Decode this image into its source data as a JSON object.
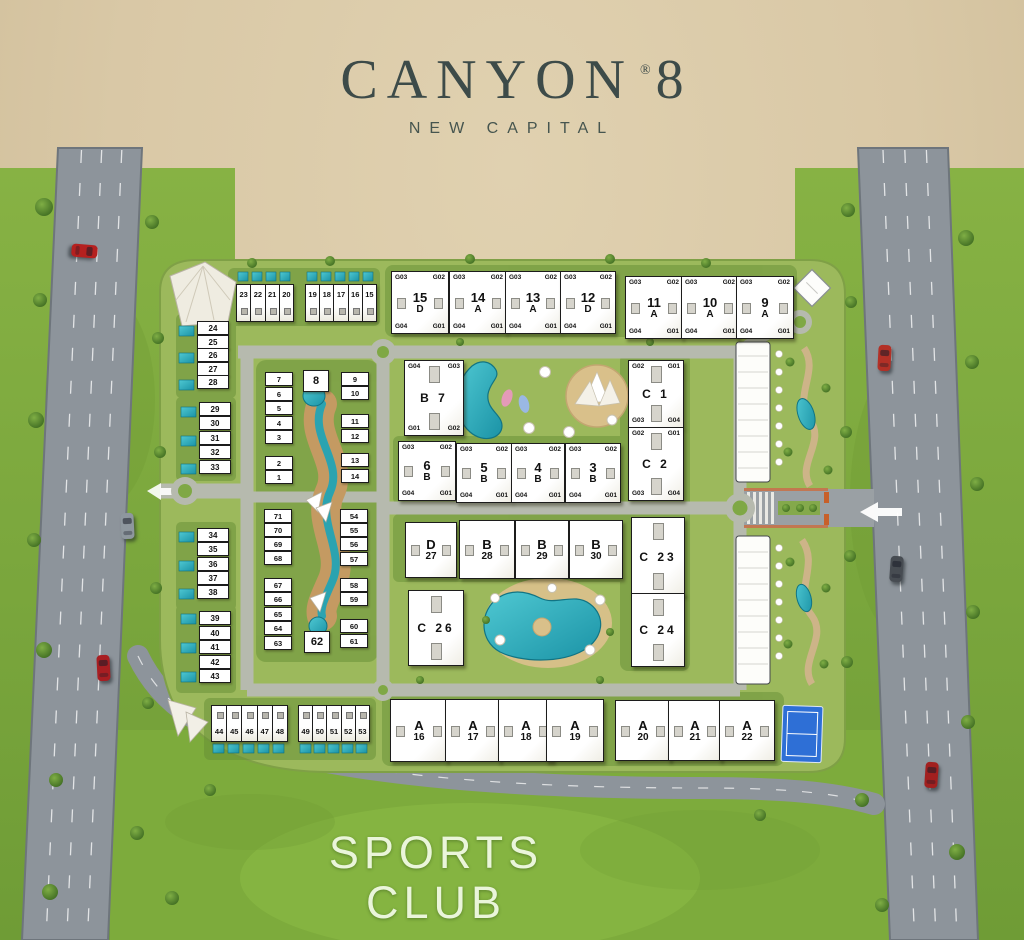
{
  "title": {
    "brand": "CANYON",
    "reg": "®",
    "number": "8",
    "subtitle": "NEW CAPITAL"
  },
  "sports_club": {
    "line1": "SPORTS",
    "line2": "CLUB"
  },
  "colors": {
    "background": "#d9c8a6",
    "grass": "#7fa93f",
    "site": "#9cb95c",
    "road": "#8d949b",
    "inner_road": "#b6baae",
    "pool": "#2aa8b5",
    "sand": "#d9c08a",
    "canyon_path": "#c49a62",
    "building": "#ffffff",
    "building_border": "#1c1c1c",
    "title_text": "#3d4b49",
    "sports_text": "#eaf5da",
    "court": "#2e6fd6"
  },
  "buildings": [
    {
      "id": "15-D",
      "x": 391,
      "y": 271,
      "w": 56,
      "h": 61,
      "top": "15",
      "bottom": "D",
      "corners": {
        "tl": "G03",
        "tr": "G02",
        "bl": "G04",
        "br": "G01"
      },
      "win": "h"
    },
    {
      "id": "14-A",
      "x": 449,
      "y": 271,
      "w": 56,
      "h": 61,
      "top": "14",
      "bottom": "A",
      "corners": {
        "tl": "G03",
        "tr": "G02",
        "bl": "G04",
        "br": "G01"
      },
      "win": "h"
    },
    {
      "id": "13-A",
      "x": 505,
      "y": 271,
      "w": 54,
      "h": 61,
      "top": "13",
      "bottom": "A",
      "corners": {
        "tl": "G03",
        "tr": "G02",
        "bl": "G04",
        "br": "G01"
      },
      "win": "h"
    },
    {
      "id": "12-D",
      "x": 560,
      "y": 271,
      "w": 54,
      "h": 61,
      "top": "12",
      "bottom": "D",
      "corners": {
        "tl": "G03",
        "tr": "G02",
        "bl": "G04",
        "br": "G01"
      },
      "win": "h"
    },
    {
      "id": "11-A",
      "x": 625,
      "y": 276,
      "w": 56,
      "h": 61,
      "top": "11",
      "bottom": "A",
      "corners": {
        "tl": "G03",
        "tr": "G02",
        "bl": "G04",
        "br": "G01"
      },
      "win": "h"
    },
    {
      "id": "10-A",
      "x": 681,
      "y": 276,
      "w": 56,
      "h": 61,
      "top": "10",
      "bottom": "A",
      "corners": {
        "tl": "G03",
        "tr": "G02",
        "bl": "G04",
        "br": "G01"
      },
      "win": "h"
    },
    {
      "id": "9-A",
      "x": 736,
      "y": 276,
      "w": 56,
      "h": 61,
      "top": "9",
      "bottom": "A",
      "corners": {
        "tl": "G03",
        "tr": "G02",
        "bl": "G04",
        "br": "G01"
      },
      "win": "h"
    },
    {
      "id": "B-7",
      "x": 404,
      "y": 360,
      "w": 58,
      "h": 74,
      "center": "B 7",
      "corners": {
        "tl": "G04",
        "tr": "G03",
        "bl": "G01",
        "br": "G02"
      },
      "win": "v"
    },
    {
      "id": "6-B",
      "x": 398,
      "y": 441,
      "w": 56,
      "h": 58,
      "top": "6",
      "bottom": "B",
      "corners": {
        "tl": "G03",
        "tr": "G02",
        "bl": "G04",
        "br": "G01"
      },
      "win": "h"
    },
    {
      "id": "5-B",
      "x": 456,
      "y": 443,
      "w": 54,
      "h": 58,
      "top": "5",
      "bottom": "B",
      "corners": {
        "tl": "G03",
        "tr": "G02",
        "bl": "G04",
        "br": "G01"
      },
      "win": "h"
    },
    {
      "id": "4-B",
      "x": 511,
      "y": 443,
      "w": 52,
      "h": 58,
      "top": "4",
      "bottom": "B",
      "corners": {
        "tl": "G03",
        "tr": "G02",
        "bl": "G04",
        "br": "G01"
      },
      "win": "h"
    },
    {
      "id": "3-B",
      "x": 565,
      "y": 443,
      "w": 54,
      "h": 58,
      "top": "3",
      "bottom": "B",
      "corners": {
        "tl": "G03",
        "tr": "G02",
        "bl": "G04",
        "br": "G01"
      },
      "win": "h"
    },
    {
      "id": "C-1",
      "x": 628,
      "y": 360,
      "w": 54,
      "h": 66,
      "center": "C 1",
      "corners": {
        "tl": "G02",
        "tr": "G01",
        "bl": "G03",
        "br": "G04"
      },
      "win": "v"
    },
    {
      "id": "C-2",
      "x": 628,
      "y": 427,
      "w": 54,
      "h": 72,
      "center": "C 2",
      "corners": {
        "tl": "G02",
        "tr": "G01",
        "bl": "G03",
        "br": "G04"
      },
      "win": "v"
    },
    {
      "id": "D-27",
      "x": 405,
      "y": 522,
      "w": 50,
      "h": 54,
      "top": "D",
      "bottom": "27",
      "win": "h"
    },
    {
      "id": "B-28",
      "x": 459,
      "y": 520,
      "w": 54,
      "h": 57,
      "top": "B",
      "bottom": "28",
      "win": "h"
    },
    {
      "id": "B-29",
      "x": 515,
      "y": 520,
      "w": 52,
      "h": 57,
      "top": "B",
      "bottom": "29",
      "win": "h"
    },
    {
      "id": "B-30",
      "x": 569,
      "y": 520,
      "w": 52,
      "h": 57,
      "top": "B",
      "bottom": "30",
      "win": "h"
    },
    {
      "id": "C-23",
      "x": 631,
      "y": 517,
      "w": 52,
      "h": 77,
      "center": "C 23",
      "win": "v"
    },
    {
      "id": "C-24",
      "x": 631,
      "y": 593,
      "w": 52,
      "h": 72,
      "center": "C 24",
      "win": "v"
    },
    {
      "id": "C-26",
      "x": 408,
      "y": 590,
      "w": 54,
      "h": 74,
      "center": "C 26",
      "win": "v"
    },
    {
      "id": "A-16",
      "x": 390,
      "y": 699,
      "w": 56,
      "h": 61,
      "top": "A",
      "bottom": "16",
      "win": "h"
    },
    {
      "id": "A-17",
      "x": 445,
      "y": 699,
      "w": 54,
      "h": 61,
      "top": "A",
      "bottom": "17",
      "win": "h"
    },
    {
      "id": "A-18",
      "x": 498,
      "y": 699,
      "w": 54,
      "h": 61,
      "top": "A",
      "bottom": "18",
      "win": "h"
    },
    {
      "id": "A-19",
      "x": 546,
      "y": 699,
      "w": 56,
      "h": 61,
      "top": "A",
      "bottom": "19",
      "win": "h"
    },
    {
      "id": "A-20",
      "x": 615,
      "y": 700,
      "w": 54,
      "h": 59,
      "top": "A",
      "bottom": "20",
      "win": "h"
    },
    {
      "id": "A-21",
      "x": 668,
      "y": 700,
      "w": 52,
      "h": 59,
      "top": "A",
      "bottom": "21",
      "win": "h"
    },
    {
      "id": "A-22",
      "x": 719,
      "y": 700,
      "w": 54,
      "h": 59,
      "top": "A",
      "bottom": "22",
      "win": "h"
    }
  ],
  "townhouse_rows": [
    {
      "id": "top-1",
      "x": 236,
      "y": 284,
      "cell_w": 14,
      "h": 36,
      "label_pos": "top",
      "units": [
        "23",
        "22",
        "21",
        "20"
      ]
    },
    {
      "id": "top-2",
      "x": 305,
      "y": 284,
      "cell_w": 14,
      "h": 36,
      "label_pos": "top",
      "units": [
        "19",
        "18",
        "17",
        "16",
        "15"
      ]
    },
    {
      "id": "bottom-1",
      "x": 211,
      "y": 705,
      "cell_w": 15,
      "h": 35,
      "label_pos": "bottom",
      "units": [
        "44",
        "45",
        "46",
        "47",
        "48"
      ]
    },
    {
      "id": "bottom-2",
      "x": 298,
      "y": 705,
      "cell_w": 14,
      "h": 35,
      "label_pos": "bottom",
      "units": [
        "49",
        "50",
        "51",
        "52",
        "53"
      ]
    }
  ],
  "unit_columns": [
    {
      "id": "col-24-28",
      "x": 197,
      "y": 321,
      "step": 13.6,
      "cell_w": 30,
      "cell_h": 12,
      "units": [
        "24",
        "25",
        "26",
        "27",
        "28"
      ]
    },
    {
      "id": "col-29-33",
      "x": 199,
      "y": 402,
      "step": 14.4,
      "cell_w": 30,
      "cell_h": 12,
      "units": [
        "29",
        "30",
        "31",
        "32",
        "33"
      ]
    },
    {
      "id": "col-34-38",
      "x": 197,
      "y": 528,
      "step": 14.3,
      "cell_w": 30,
      "cell_h": 12,
      "units": [
        "34",
        "35",
        "36",
        "37",
        "38"
      ]
    },
    {
      "id": "col-39-43",
      "x": 199,
      "y": 611,
      "step": 14.6,
      "cell_w": 30,
      "cell_h": 12,
      "units": [
        "39",
        "40",
        "41",
        "42",
        "43"
      ]
    }
  ],
  "villa_units": [
    {
      "n": "7",
      "x": 265,
      "y": 372
    },
    {
      "n": "6",
      "x": 265,
      "y": 387
    },
    {
      "n": "5",
      "x": 265,
      "y": 401
    },
    {
      "n": "4",
      "x": 265,
      "y": 416
    },
    {
      "n": "3",
      "x": 265,
      "y": 430
    },
    {
      "n": "2",
      "x": 265,
      "y": 456
    },
    {
      "n": "1",
      "x": 265,
      "y": 470
    },
    {
      "n": "8",
      "x": 303,
      "y": 370,
      "big": true
    },
    {
      "n": "9",
      "x": 341,
      "y": 372
    },
    {
      "n": "10",
      "x": 341,
      "y": 386
    },
    {
      "n": "11",
      "x": 341,
      "y": 414
    },
    {
      "n": "12",
      "x": 341,
      "y": 429
    },
    {
      "n": "13",
      "x": 341,
      "y": 453
    },
    {
      "n": "14",
      "x": 341,
      "y": 469
    },
    {
      "n": "71",
      "x": 264,
      "y": 509
    },
    {
      "n": "70",
      "x": 264,
      "y": 523
    },
    {
      "n": "69",
      "x": 264,
      "y": 537
    },
    {
      "n": "68",
      "x": 264,
      "y": 551
    },
    {
      "n": "67",
      "x": 264,
      "y": 578
    },
    {
      "n": "66",
      "x": 264,
      "y": 592
    },
    {
      "n": "65",
      "x": 264,
      "y": 607
    },
    {
      "n": "64",
      "x": 264,
      "y": 621
    },
    {
      "n": "63",
      "x": 264,
      "y": 636
    },
    {
      "n": "54",
      "x": 340,
      "y": 509
    },
    {
      "n": "55",
      "x": 340,
      "y": 523
    },
    {
      "n": "56",
      "x": 340,
      "y": 537
    },
    {
      "n": "57",
      "x": 340,
      "y": 552
    },
    {
      "n": "58",
      "x": 340,
      "y": 578
    },
    {
      "n": "59",
      "x": 340,
      "y": 592
    },
    {
      "n": "60",
      "x": 340,
      "y": 619
    },
    {
      "n": "61",
      "x": 340,
      "y": 634
    },
    {
      "n": "62",
      "x": 304,
      "y": 631,
      "big": true
    }
  ],
  "vehicles": [
    {
      "id": "car-left-1",
      "x": 78,
      "y": 238,
      "color": "#b5201f",
      "rot": 95
    },
    {
      "id": "car-left-2",
      "x": 121,
      "y": 513,
      "color": "#8e979e",
      "rot": -3
    },
    {
      "id": "car-left-3",
      "x": 97,
      "y": 655,
      "color": "#a81e22",
      "rot": -3
    },
    {
      "id": "car-right-1",
      "x": 878,
      "y": 345,
      "color": "#b33026",
      "rot": 3
    },
    {
      "id": "car-right-2",
      "x": 890,
      "y": 556,
      "color": "#474c52",
      "rot": 4
    },
    {
      "id": "car-right-3",
      "x": 925,
      "y": 762,
      "color": "#a2201f",
      "rot": 4
    }
  ]
}
